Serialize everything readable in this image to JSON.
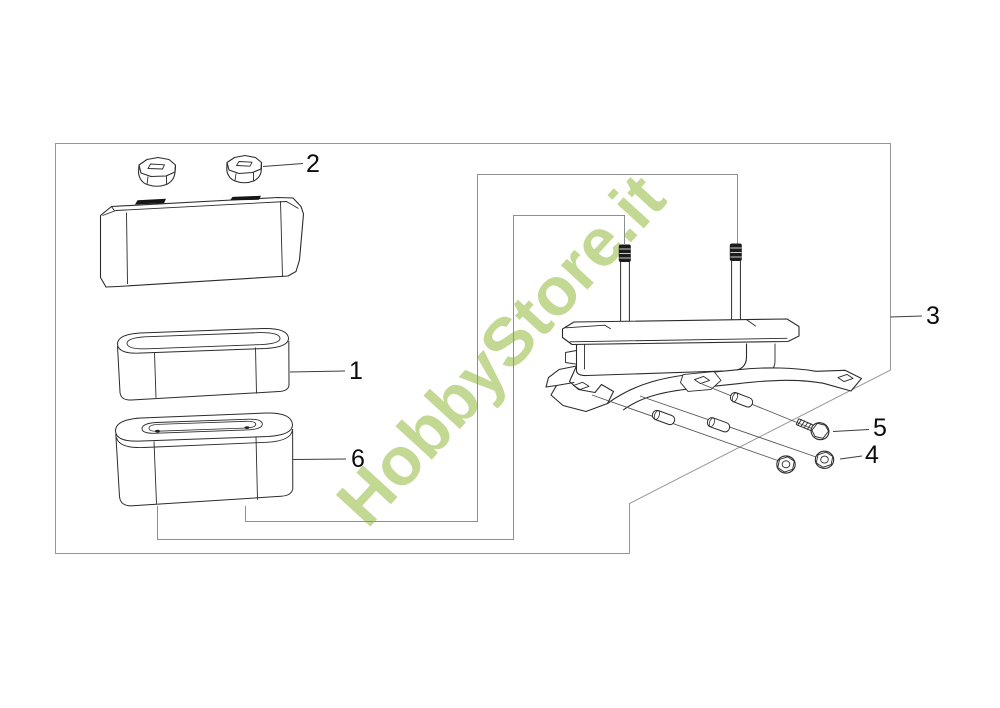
{
  "watermark": {
    "text": "HobbyStore.it",
    "color": "#c2d893"
  },
  "callouts": {
    "part2": "2",
    "part1": "1",
    "part6": "6",
    "part3": "3",
    "part5": "5",
    "part4": "4"
  },
  "diagram": {
    "line_color": "#2b2b2b",
    "frame_color": "#979797"
  }
}
